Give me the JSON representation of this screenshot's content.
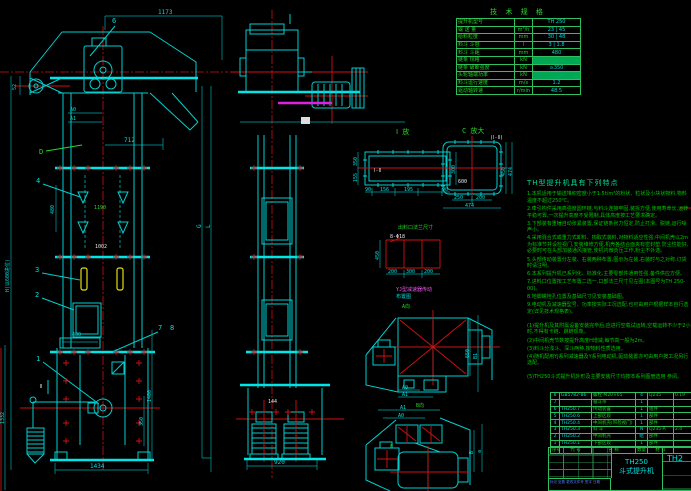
{
  "colors": {
    "background": "#000000",
    "line_cyan": "#00cfcf",
    "line_green": "#22d922",
    "line_red": "#cf1111",
    "line_magenta": "#e020e0",
    "line_yellow": "#dede16",
    "text_blue": "#5577ff",
    "table_green": "#2fbf5f"
  },
  "spec": {
    "title": "技 术 规 格",
    "rows": [
      {
        "label": "提升机型号",
        "unit": "",
        "val": "TH 250"
      },
      {
        "label": "输 送 量",
        "unit": "m³/h",
        "val": "23 | 45"
      },
      {
        "label": "给料粒度",
        "unit": "mm",
        "val": "30 | 48"
      },
      {
        "label": "料斗 斗容",
        "unit": "l",
        "val": "3 | 1.8"
      },
      {
        "label": "料斗 斗距",
        "unit": "mm",
        "val": "480"
      },
      {
        "label": "链条 规格",
        "unit": "kN",
        "val": "",
        "hl": true
      },
      {
        "label": "链条 破断强度",
        "unit": "kN",
        "val": "≥350"
      },
      {
        "label": "头轮轴端功率",
        "unit": "kN",
        "val": "",
        "hl": true
      },
      {
        "label": "料斗运行速度",
        "unit": "m/s",
        "val": "1.2"
      },
      {
        "label": "驱动轴转速",
        "unit": "r/min",
        "val": "48.5"
      }
    ]
  },
  "notes": {
    "heading": "TH型提升机具有下列特点",
    "lines": [
      "1.本机适用于输送堆积密度小于1.5t/m³的粉状、粒状及小块状物料,物料温度不超过250℃。",
      "2.牵引构件采用高强度圆环链,与料斗连接牢固,装拆方便,使用寿命长,运转平稳可靠,一次提升高度不受限制,具体高度按工艺要求确定。",
      "3.下部装有重锤自动张紧装置,保证链条张力恒定,防止打滑、脱链,运行噪声小。",
      "4.采用混合式或重力式卸料、掏取式装料,对物料适应性强,中间机壳以2m为标准节并设检视门,安装维修方便,机壳各结合面夹有密封垫,防尘性能好,必要时可在头部加装通风接管,使机内微负压工作,粉尘不外逸。",
      "5.头部传动装置分左装、右装两种布置,图示为左装,右装时与之对称,订货时请注明。",
      "6.本系列提升机已系列化、标准化,主要零部件通用性强,备件供应方便。",
      "7.进料口位置按工艺布置二选一,口部法兰尺寸见左图(本图号为TH 250-00)。",
      "8.地脚螺栓孔位置及基础尺寸见安装基础图。",
      "9.电动机及减速器型号、功率按实际工况选配,也可由用户根据样本自行选定(详见技术规格表)。"
    ],
    "sub": [
      "(1)提升机及其附属设备安装完毕后,应进行空载试运转,空载运转不少于2小时,不得有卡链、跳链现象。",
      "(2)中间机壳节数按提升高度H增减,每节高一般为2m。",
      "(3)料斗分浅斗、深斗两种,按物料性质选用。",
      "(4)随机配用YJ系列减速器及Y系列电动机,驱动装置亦可由用户按工况另行选配。"
    ],
    "last": "(5)TH250斗式提升机外形及主要安装尺寸均按本系列图册选用 参阅。"
  },
  "bom": {
    "headers": [
      "序号",
      "代  号",
      "名  称",
      "数量",
      "材 料",
      "单重"
    ],
    "rows": [
      [
        "8",
        "GB5782-86",
        "螺栓 M20×65",
        "4",
        "Q235",
        "0.19"
      ],
      [
        "7",
        "",
        "畚斗带",
        "1",
        "",
        ""
      ],
      [
        "6",
        "TH250.7",
        "传动装置",
        "1",
        "组件",
        ""
      ],
      [
        "5",
        "TH250.6",
        "上部区段",
        "1",
        "部件",
        ""
      ],
      [
        "4",
        "TH250.4",
        "中间机壳(带检视门)",
        "1",
        "部件",
        ""
      ],
      [
        "3",
        "TH250.3",
        "料 斗",
        "N",
        "Q235-A",
        "2.4"
      ],
      [
        "2",
        "TH250.2",
        "中间机壳",
        "组",
        "部件",
        ""
      ],
      [
        "1",
        "TH250.1",
        "下部区段",
        "1",
        "部件",
        ""
      ]
    ]
  },
  "title_block": {
    "product": "TH250",
    "product2": "斗式提升机",
    "dwg_no": "TH2",
    "sig_row": "标记 处数 更改文件号 签字 日期"
  },
  "left_view": {
    "dim_top": "1173",
    "dim_712": "712",
    "a0": "A0",
    "a1": "A1",
    "dim_52": "52",
    "callout_6": "6",
    "view_d": "D",
    "callout_4": "4",
    "dim_480_mid": "480",
    "text_1190": "1190",
    "text_1002": "1002",
    "callout_3": "3",
    "callout_2": "2",
    "callout_1": "1",
    "callout_7": "7",
    "callout_8": "8",
    "section_2": "Ⅱ",
    "dim_480_boot": "480",
    "dim_1434": "1434",
    "dim_1332": "1332",
    "dim_1400": "1400",
    "dim_350": "350",
    "dim_h": "H(以600进位)",
    "label_g": "G",
    "label_l": "L"
  },
  "side_view": {
    "dim_920": "920",
    "dim_144": "144"
  },
  "flange_i": {
    "title": "Ⅰ 放",
    "inner": "Ⅰ-Ⅱ",
    "left_top": "350",
    "left_bot": "155",
    "right": "300",
    "b1": "90",
    "b2": "156",
    "b3": "195",
    "b4": "90"
  },
  "flange_c": {
    "title": "C 放大",
    "note": "(Ⅰ-Ⅱ)",
    "inner": "600",
    "right1": "450",
    "right2": "474",
    "b1": "250",
    "b2": "200",
    "b_total": "474"
  },
  "bolt_grid": {
    "caption": "出料口法兰尺寸",
    "holes": "8-Φ18",
    "left": "450",
    "c1": "200",
    "c2": "300",
    "c3": "200"
  },
  "yj_view": {
    "title1": "YJ型减速器传动",
    "title2": "布置图",
    "tag": "A向",
    "dim_650": "650",
    "dim_b1": "B1",
    "a0": "A0",
    "a1": "A1"
  },
  "alt_view": {
    "a1": "A1",
    "a0": "A0",
    "dim_b": "B",
    "dim_a": "a",
    "tag": "B向",
    "f": "F"
  }
}
